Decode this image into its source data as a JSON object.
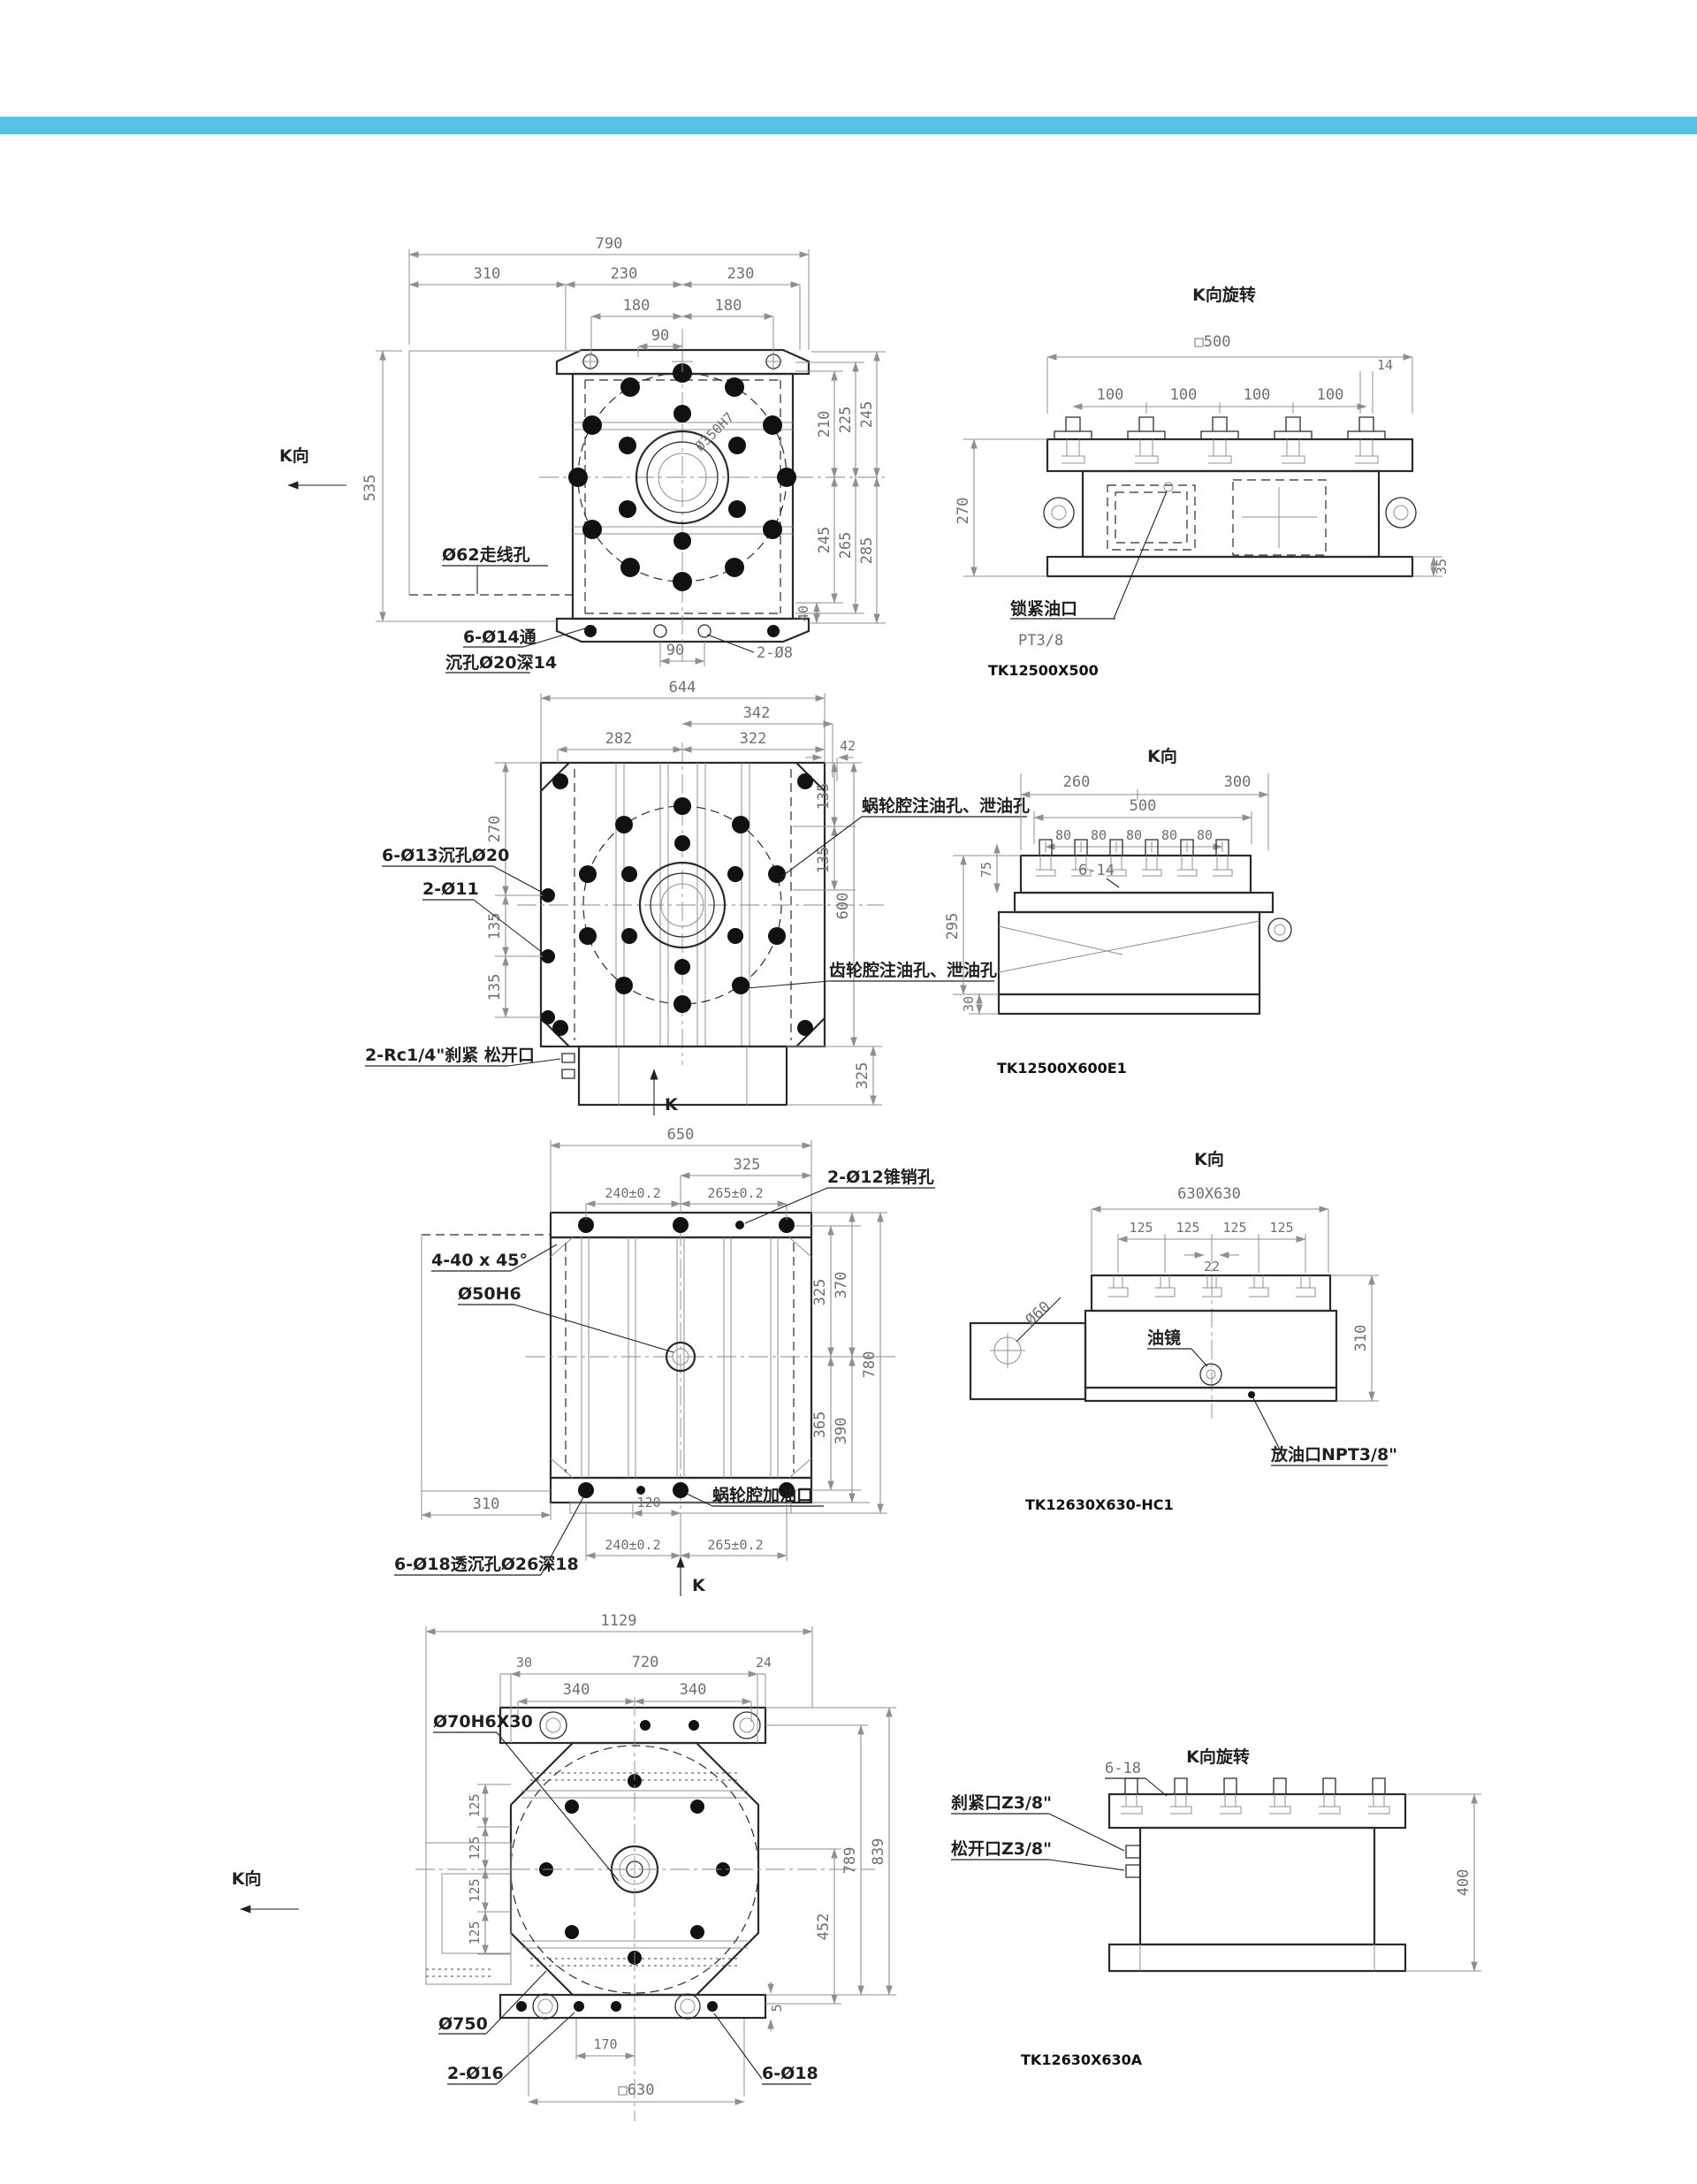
{
  "page": {
    "accent_bar_color": "#55c3e6",
    "background": "#ffffff"
  },
  "g1": {
    "plan": {
      "k_view": "K向",
      "dim_overall": "790",
      "dim_310": "310",
      "dim_230_left": "230",
      "dim_230_right": "230",
      "dim_180_left": "180",
      "dim_180_right": "180",
      "dim_90_top": "90",
      "dim_535": "535",
      "dim_210": "210",
      "dim_225": "225",
      "dim_245_top": "245",
      "dim_245_bottom": "245",
      "dim_265": "265",
      "dim_285": "285",
      "dim_40": "40",
      "dim_90_bottom": "90",
      "label_wire_hole": "Ø62走线孔",
      "label_bolt_line1": "6-Ø14通",
      "label_bolt_line2": "沉孔Ø20深14",
      "label_pins": "2-Ø8",
      "label_bore": "Ø350H7"
    },
    "side": {
      "title": "K向旋转",
      "dim_square": "□500",
      "dim_100s": [
        "100",
        "100",
        "100",
        "100"
      ],
      "dim_14": "14",
      "dim_270": "270",
      "dim_35": "35",
      "label_lock_port": "锁紧油口",
      "label_lock_thread": "PT3/8",
      "part_no": "TK12500X500"
    }
  },
  "g2": {
    "plan": {
      "dim_overall": "644",
      "dim_342": "342",
      "dim_282": "282",
      "dim_322": "322",
      "dim_42": "42",
      "dim_270": "270",
      "dim_135_l1": "135",
      "dim_135_l2": "135",
      "dim_135_r1": "135",
      "dim_135_r2": "135",
      "dim_600": "600",
      "dim_325": "325",
      "label_cbore": "6-Ø13沉孔Ø20",
      "label_pins": "2-Ø11",
      "label_rc": "2-Rc1/4\"刹紧 松开口",
      "label_worm_ports": "蜗轮腔注油孔、泄油孔",
      "label_gear_ports": "齿轮腔注油孔、泄油孔",
      "k_arrow": "K"
    },
    "side": {
      "title": "K向",
      "dim_260": "260",
      "dim_300": "300",
      "dim_500": "500",
      "dim_80s": [
        "80",
        "80",
        "80",
        "80",
        "80"
      ],
      "label_slots": "6-14",
      "dim_75": "75",
      "dim_295": "295",
      "dim_30": "30",
      "part_no": "TK12500X600E1"
    }
  },
  "g3": {
    "plan": {
      "dim_overall": "650",
      "dim_325": "325",
      "dim_240_top": "240±0.2",
      "dim_265_top": "265±0.2",
      "label_taper_pins": "2-Ø12锥销孔",
      "label_chamfer": "4-40 x 45°",
      "label_bore": "Ø50H6",
      "dim_310": "310",
      "dim_120": "120",
      "label_oil_fill": "蜗轮腔加油口",
      "label_cbore": "6-Ø18透沉孔Ø26深18",
      "dim_240_bottom": "240±0.2",
      "dim_265_bottom": "265±0.2",
      "dim_325_right": "325",
      "dim_370": "370",
      "dim_365": "365",
      "dim_390": "390",
      "dim_780": "780",
      "k_arrow": "K"
    },
    "side": {
      "title": "K向",
      "dim_square": "630X630",
      "dim_125s": [
        "125",
        "125",
        "125",
        "125"
      ],
      "dim_22": "22",
      "label_shaft": "Ø60",
      "label_sight": "油镜",
      "dim_310": "310",
      "label_drain": "放油口NPT3/8\"",
      "part_no": "TK12630X630-HC1"
    }
  },
  "g4": {
    "plan": {
      "dim_overall": "1129",
      "dim_30": "30",
      "dim_720": "720",
      "dim_24": "24",
      "dim_340_left": "340",
      "dim_340_right": "340",
      "label_bore": "Ø70H6X30",
      "dim_125s": [
        "125",
        "125",
        "125",
        "125"
      ],
      "k_view": "K向",
      "label_circle": "Ø750",
      "label_pins": "2-Ø16",
      "dim_170": "170",
      "dim_square": "□630",
      "label_cbore": "6-Ø18",
      "dim_452": "452",
      "dim_789": "789",
      "dim_839": "839",
      "dim_5": "5"
    },
    "side": {
      "title": "K向旋转",
      "label_slots": "6-18",
      "label_clamp": "刹紧口Z3/8\"",
      "label_release": "松开口Z3/8\"",
      "dim_400": "400",
      "part_no": "TK12630X630A"
    }
  }
}
